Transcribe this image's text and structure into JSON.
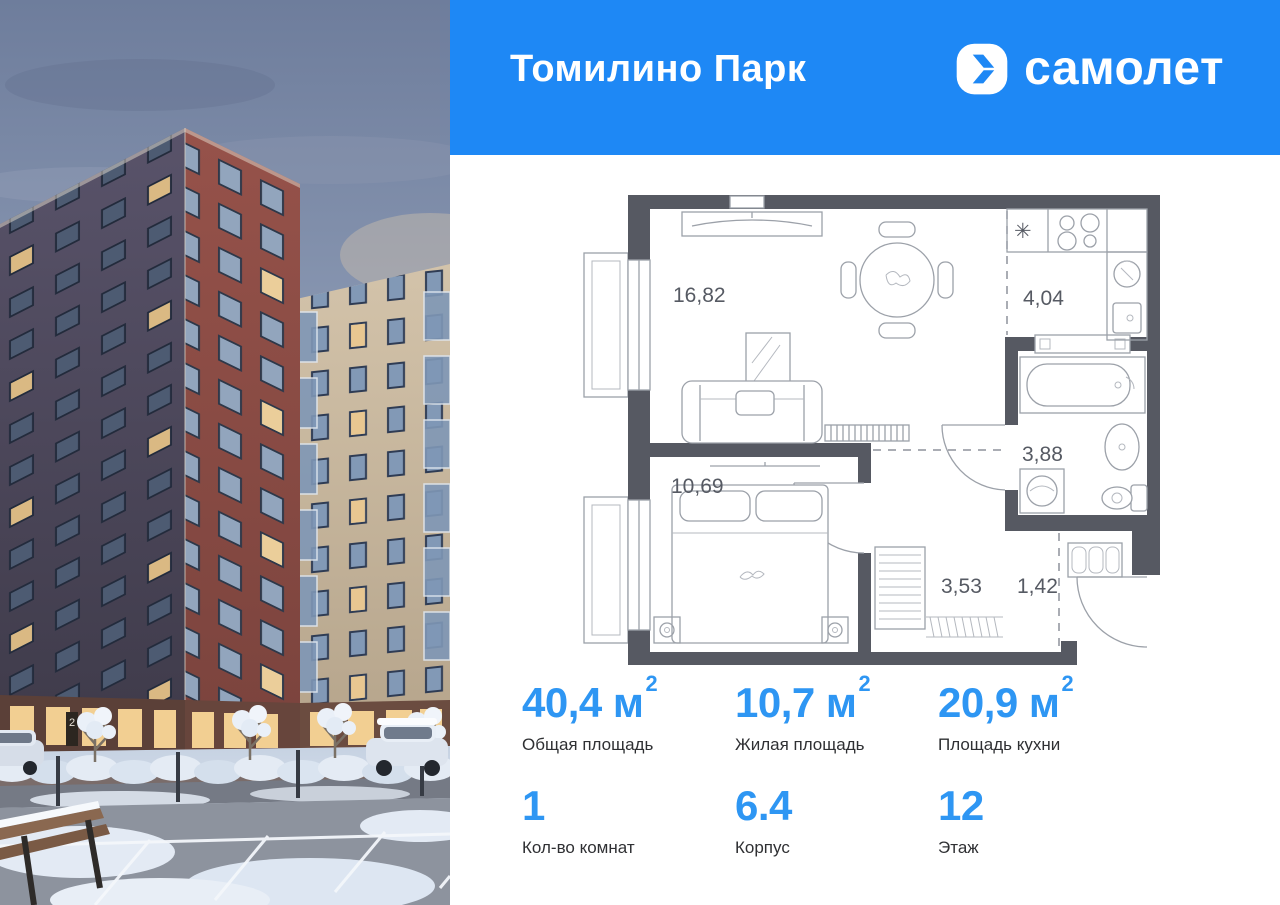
{
  "colors": {
    "header_blue": "#1e88f5",
    "accent_blue": "#2e96f3",
    "plan_wall": "#565962"
  },
  "header": {
    "title": "Томилино Парк",
    "brand_name": "самолет"
  },
  "photo": {
    "entrance_number": "2"
  },
  "floorplan": {
    "rooms": [
      {
        "name": "living-room",
        "area": "16,82"
      },
      {
        "name": "kitchen",
        "area": "4,04"
      },
      {
        "name": "bathroom",
        "area": "3,88"
      },
      {
        "name": "bedroom",
        "area": "10,69"
      },
      {
        "name": "hallway",
        "area": "3,53"
      },
      {
        "name": "entry",
        "area": "1,42"
      }
    ],
    "icons": {
      "fridge": "✳"
    }
  },
  "stats": {
    "cells": [
      {
        "value": "40,4",
        "unit": " м",
        "sup": "2",
        "label": "Общая площадь"
      },
      {
        "value": "10,7",
        "unit": " м",
        "sup": "2",
        "label": "Жилая площадь"
      },
      {
        "value": "20,9",
        "unit": " м",
        "sup": "2",
        "label": "Площадь кухни"
      },
      {
        "value": "1",
        "unit": "",
        "sup": "",
        "label": "Кол-во комнат"
      },
      {
        "value": "6.4",
        "unit": "",
        "sup": "",
        "label": "Корпус"
      },
      {
        "value": "12",
        "unit": "",
        "sup": "",
        "label": "Этаж"
      }
    ]
  }
}
